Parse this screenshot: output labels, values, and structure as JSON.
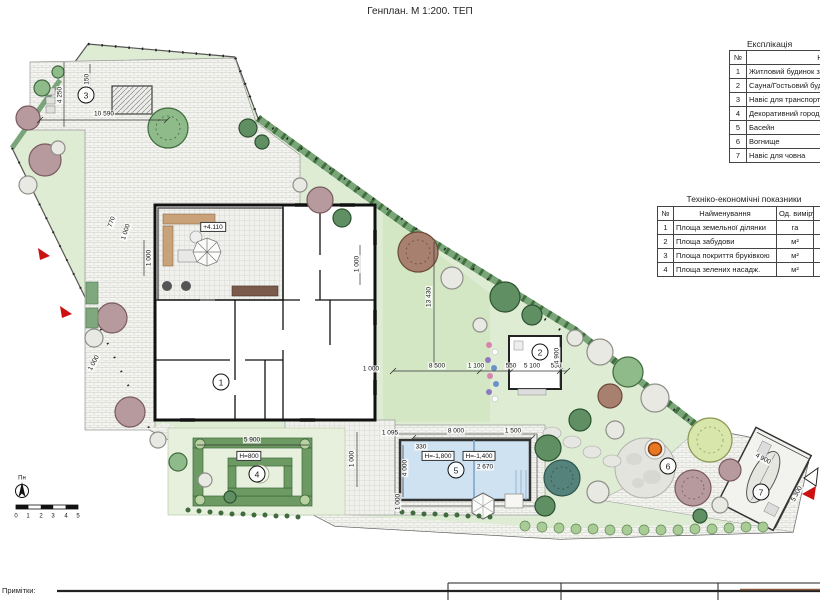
{
  "title": "Генплан. М 1:200. ТЕП",
  "explication": {
    "title": "Експлікація",
    "col_no": "№",
    "col_name": "Найменування",
    "rows": [
      {
        "no": "1",
        "name": "Житловий будинок з"
      },
      {
        "no": "2",
        "name": "Сауна/Гостьовий буд"
      },
      {
        "no": "3",
        "name": "Навіс для транспорту"
      },
      {
        "no": "4",
        "name": "Декоративний город"
      },
      {
        "no": "5",
        "name": "Басейн"
      },
      {
        "no": "6",
        "name": "Вогнище"
      },
      {
        "no": "7",
        "name": "Навіс для човна"
      }
    ]
  },
  "tep": {
    "title": "Техніко-економічні показники",
    "col_no": "№",
    "col_name": "Найменування",
    "col_unit": "Од. виміру",
    "rows": [
      {
        "no": "1",
        "name": "Площа земельної ділянки",
        "unit": "га"
      },
      {
        "no": "2",
        "name": "Площа забудови",
        "unit": "м²"
      },
      {
        "no": "3",
        "name": "Площа покриття бруківкою",
        "unit": "м²"
      },
      {
        "no": "4",
        "name": "Площа зелених насадж.",
        "unit": "м²"
      }
    ]
  },
  "notes_label": "Примітки:",
  "plan": {
    "callouts": [
      {
        "n": "1",
        "x": 221,
        "y": 382
      },
      {
        "n": "2",
        "x": 540,
        "y": 352
      },
      {
        "n": "3",
        "x": 86,
        "y": 95
      },
      {
        "n": "4",
        "x": 257,
        "y": 474
      },
      {
        "n": "5",
        "x": 456,
        "y": 470
      },
      {
        "n": "6",
        "x": 668,
        "y": 466
      },
      {
        "n": "7",
        "x": 761,
        "y": 492
      }
    ],
    "labels": [
      {
        "text": "4 250",
        "x": 60,
        "y": 95,
        "rot": -90
      },
      {
        "text": "4 150",
        "x": 87,
        "y": 82,
        "rot": -90
      },
      {
        "text": "10 590",
        "x": 104,
        "y": 114
      },
      {
        "text": "770",
        "x": 112,
        "y": 222,
        "rot": -72
      },
      {
        "text": "1 000",
        "x": 126,
        "y": 232,
        "rot": -72
      },
      {
        "text": "1 000",
        "x": 149,
        "y": 258,
        "rot": -90
      },
      {
        "text": "+4.110",
        "x": 213,
        "y": 227,
        "cls": "boxed"
      },
      {
        "text": "1 000",
        "x": 357,
        "y": 264,
        "rot": -90
      },
      {
        "text": "13 430",
        "x": 429,
        "y": 297,
        "rot": -90
      },
      {
        "text": "8 500",
        "x": 437,
        "y": 366
      },
      {
        "text": "1 100",
        "x": 476,
        "y": 366
      },
      {
        "text": "550",
        "x": 511,
        "y": 366
      },
      {
        "text": "5 100",
        "x": 532,
        "y": 366
      },
      {
        "text": "550",
        "x": 556,
        "y": 366
      },
      {
        "text": "4 900",
        "x": 557,
        "y": 356,
        "rot": -90
      },
      {
        "text": "1 000",
        "x": 371,
        "y": 369
      },
      {
        "text": "1 095",
        "x": 390,
        "y": 433
      },
      {
        "text": "8 000",
        "x": 456,
        "y": 431
      },
      {
        "text": "1 500",
        "x": 513,
        "y": 431
      },
      {
        "text": "330",
        "x": 421,
        "y": 447
      },
      {
        "text": "H=-1,800",
        "x": 438,
        "y": 456,
        "cls": "boxed"
      },
      {
        "text": "H=-1,400",
        "x": 479,
        "y": 456,
        "cls": "boxed"
      },
      {
        "text": "2 670",
        "x": 485,
        "y": 467
      },
      {
        "text": "4 000",
        "x": 405,
        "y": 468,
        "rot": -90
      },
      {
        "text": "1 000",
        "x": 398,
        "y": 502,
        "rot": -90
      },
      {
        "text": "5 900",
        "x": 252,
        "y": 440
      },
      {
        "text": "H=800",
        "x": 249,
        "y": 456,
        "cls": "boxed"
      },
      {
        "text": "1 000",
        "x": 352,
        "y": 459,
        "rot": -90
      },
      {
        "text": "4 900",
        "x": 763,
        "y": 459,
        "rot": 28
      },
      {
        "text": "5 300",
        "x": 797,
        "y": 494,
        "rot": -62
      },
      {
        "text": "1 000",
        "x": 94,
        "y": 363,
        "rot": -62
      },
      {
        "text": "Пн",
        "x": 22,
        "y": 479,
        "cls": "tick"
      },
      {
        "text": "0",
        "x": 16,
        "y": 517,
        "cls": "tick"
      },
      {
        "text": "1",
        "x": 28,
        "y": 517,
        "cls": "tick"
      },
      {
        "text": "2",
        "x": 41,
        "y": 517,
        "cls": "tick"
      },
      {
        "text": "3",
        "x": 53,
        "y": 517,
        "cls": "tick"
      },
      {
        "text": "4",
        "x": 66,
        "y": 517,
        "cls": "tick"
      },
      {
        "text": "5",
        "x": 78,
        "y": 517,
        "cls": "tick"
      }
    ]
  },
  "colors": {
    "lawn": "#ddecd3",
    "lawn_dark": "#d3e7c4",
    "pool_water": "#cfe2f1",
    "hedge": "#79a579",
    "fire_pit": "#e87722",
    "entrance_arrow": "#cc1111",
    "wall": "#111111"
  }
}
